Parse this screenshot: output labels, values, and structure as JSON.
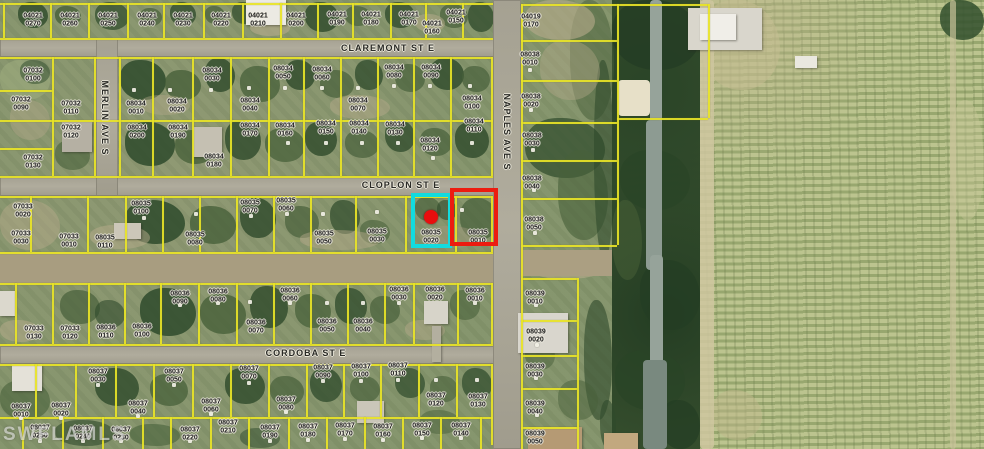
{
  "watermark": "SWFLAMLS",
  "colors": {
    "parcel_line": "#e9e427",
    "subject_highlight": "#12dbde",
    "adjacent_highlight": "#ec1c10",
    "marker": "#e80e0e"
  },
  "street_labels": [
    {
      "name": "CLAREMONT ST E",
      "x": 388,
      "y": 48,
      "vertical": false
    },
    {
      "name": "CLOPLON ST E",
      "x": 401,
      "y": 185,
      "vertical": false
    },
    {
      "name": "CORDOBA ST E",
      "x": 306,
      "y": 353,
      "vertical": false
    },
    {
      "name": "MERLIN AVE S",
      "x": 105,
      "y": 118,
      "vertical": true
    },
    {
      "name": "NAPLES AVE S",
      "x": 507,
      "y": 132,
      "vertical": true
    }
  ],
  "highlights": {
    "subject_parcel": "08035 0020",
    "adjacent_parcel": "08035 0010",
    "marker": {
      "x": 431,
      "y": 217
    }
  },
  "parcel_labels": [
    {
      "block": "04021",
      "lot": "0270",
      "x": 33,
      "y": 20
    },
    {
      "block": "04021",
      "lot": "0260",
      "x": 70,
      "y": 20
    },
    {
      "block": "04021",
      "lot": "0250",
      "x": 108,
      "y": 20
    },
    {
      "block": "04021",
      "lot": "0240",
      "x": 147,
      "y": 20
    },
    {
      "block": "04021",
      "lot": "0230",
      "x": 183,
      "y": 20
    },
    {
      "block": "04021",
      "lot": "0220",
      "x": 221,
      "y": 20
    },
    {
      "block": "04021",
      "lot": "0210",
      "x": 258,
      "y": 20
    },
    {
      "block": "04021",
      "lot": "0200",
      "x": 296,
      "y": 20
    },
    {
      "block": "04021",
      "lot": "0190",
      "x": 337,
      "y": 19
    },
    {
      "block": "04021",
      "lot": "0180",
      "x": 371,
      "y": 19
    },
    {
      "block": "04021",
      "lot": "0170",
      "x": 409,
      "y": 19
    },
    {
      "block": "04021",
      "lot": "0160",
      "x": 432,
      "y": 28
    },
    {
      "block": "04021",
      "lot": "0150",
      "x": 456,
      "y": 17
    },
    {
      "block": "04019",
      "lot": "0170",
      "x": 531,
      "y": 21
    },
    {
      "block": "07032",
      "lot": "0100",
      "x": 33,
      "y": 75
    },
    {
      "block": "07032",
      "lot": "0090",
      "x": 21,
      "y": 104
    },
    {
      "block": "07032",
      "lot": "0110",
      "x": 71,
      "y": 108
    },
    {
      "block": "07032",
      "lot": "0120",
      "x": 71,
      "y": 132
    },
    {
      "block": "07032",
      "lot": "0130",
      "x": 33,
      "y": 162
    },
    {
      "block": "08034",
      "lot": "0010",
      "x": 136,
      "y": 108
    },
    {
      "block": "08034",
      "lot": "0020",
      "x": 177,
      "y": 106
    },
    {
      "block": "08034",
      "lot": "0030",
      "x": 212,
      "y": 75
    },
    {
      "block": "08034",
      "lot": "0040",
      "x": 250,
      "y": 105
    },
    {
      "block": "08034",
      "lot": "0050",
      "x": 283,
      "y": 73
    },
    {
      "block": "08034",
      "lot": "0060",
      "x": 322,
      "y": 74
    },
    {
      "block": "08034",
      "lot": "0070",
      "x": 358,
      "y": 105
    },
    {
      "block": "08034",
      "lot": "0080",
      "x": 394,
      "y": 72
    },
    {
      "block": "08034",
      "lot": "0090",
      "x": 431,
      "y": 72
    },
    {
      "block": "08034",
      "lot": "0100",
      "x": 472,
      "y": 103
    },
    {
      "block": "08034",
      "lot": "0200",
      "x": 137,
      "y": 132
    },
    {
      "block": "08034",
      "lot": "0190",
      "x": 178,
      "y": 132
    },
    {
      "block": "08034",
      "lot": "0180",
      "x": 214,
      "y": 161
    },
    {
      "block": "08034",
      "lot": "0170",
      "x": 250,
      "y": 130
    },
    {
      "block": "08034",
      "lot": "0160",
      "x": 285,
      "y": 130
    },
    {
      "block": "08034",
      "lot": "0150",
      "x": 326,
      "y": 128
    },
    {
      "block": "08034",
      "lot": "0140",
      "x": 359,
      "y": 128
    },
    {
      "block": "08034",
      "lot": "0130",
      "x": 395,
      "y": 129
    },
    {
      "block": "08034",
      "lot": "0120",
      "x": 430,
      "y": 145
    },
    {
      "block": "08034",
      "lot": "0110",
      "x": 474,
      "y": 126
    },
    {
      "block": "07033",
      "lot": "0020",
      "x": 23,
      "y": 211
    },
    {
      "block": "07033",
      "lot": "0030",
      "x": 21,
      "y": 238
    },
    {
      "block": "07033",
      "lot": "0010",
      "x": 69,
      "y": 241
    },
    {
      "block": "08035",
      "lot": "0110",
      "x": 105,
      "y": 242
    },
    {
      "block": "08035",
      "lot": "0100",
      "x": 141,
      "y": 208
    },
    {
      "block": "08035",
      "lot": "0080",
      "x": 195,
      "y": 239
    },
    {
      "block": "08035",
      "lot": "0070",
      "x": 250,
      "y": 207
    },
    {
      "block": "08035",
      "lot": "0060",
      "x": 286,
      "y": 205
    },
    {
      "block": "08035",
      "lot": "0050",
      "x": 324,
      "y": 238
    },
    {
      "block": "08035",
      "lot": "0030",
      "x": 377,
      "y": 236
    },
    {
      "block": "08035",
      "lot": "0020",
      "x": 431,
      "y": 237
    },
    {
      "block": "08035",
      "lot": "0010",
      "x": 478,
      "y": 237
    },
    {
      "block": "08038",
      "lot": "0010",
      "x": 530,
      "y": 59
    },
    {
      "block": "08038",
      "lot": "0020",
      "x": 531,
      "y": 101
    },
    {
      "block": "08038",
      "lot": "0030",
      "x": 532,
      "y": 140
    },
    {
      "block": "08038",
      "lot": "0040",
      "x": 532,
      "y": 183
    },
    {
      "block": "08038",
      "lot": "0050",
      "x": 534,
      "y": 224
    },
    {
      "block": "08039",
      "lot": "0010",
      "x": 535,
      "y": 298
    },
    {
      "block": "08039",
      "lot": "0020",
      "x": 536,
      "y": 336
    },
    {
      "block": "08039",
      "lot": "0030",
      "x": 535,
      "y": 371
    },
    {
      "block": "08039",
      "lot": "0040",
      "x": 535,
      "y": 408
    },
    {
      "block": "08039",
      "lot": "0050",
      "x": 535,
      "y": 438
    },
    {
      "block": "07033",
      "lot": "0130",
      "x": 34,
      "y": 333
    },
    {
      "block": "07033",
      "lot": "0120",
      "x": 70,
      "y": 333
    },
    {
      "block": "08036",
      "lot": "0110",
      "x": 106,
      "y": 332
    },
    {
      "block": "08036",
      "lot": "0100",
      "x": 142,
      "y": 331
    },
    {
      "block": "08036",
      "lot": "0090",
      "x": 180,
      "y": 298
    },
    {
      "block": "08036",
      "lot": "0080",
      "x": 218,
      "y": 296
    },
    {
      "block": "08036",
      "lot": "0070",
      "x": 256,
      "y": 327
    },
    {
      "block": "08036",
      "lot": "0060",
      "x": 290,
      "y": 295
    },
    {
      "block": "08036",
      "lot": "0050",
      "x": 327,
      "y": 326
    },
    {
      "block": "08036",
      "lot": "0040",
      "x": 363,
      "y": 326
    },
    {
      "block": "08036",
      "lot": "0030",
      "x": 399,
      "y": 294
    },
    {
      "block": "08036",
      "lot": "0020",
      "x": 435,
      "y": 294
    },
    {
      "block": "08036",
      "lot": "0010",
      "x": 475,
      "y": 295
    },
    {
      "block": "08037",
      "lot": "0030",
      "x": 98,
      "y": 376
    },
    {
      "block": "08037",
      "lot": "0050",
      "x": 174,
      "y": 376
    },
    {
      "block": "08037",
      "lot": "0070",
      "x": 249,
      "y": 373
    },
    {
      "block": "08037",
      "lot": "0090",
      "x": 323,
      "y": 372
    },
    {
      "block": "08037",
      "lot": "0100",
      "x": 361,
      "y": 371
    },
    {
      "block": "08037",
      "lot": "0110",
      "x": 398,
      "y": 370
    },
    {
      "block": "08037",
      "lot": "0120",
      "x": 436,
      "y": 400
    },
    {
      "block": "08037",
      "lot": "0130",
      "x": 478,
      "y": 401
    },
    {
      "block": "08037",
      "lot": "0010",
      "x": 21,
      "y": 411
    },
    {
      "block": "08037",
      "lot": "0020",
      "x": 61,
      "y": 410
    },
    {
      "block": "08037",
      "lot": "0040",
      "x": 138,
      "y": 408
    },
    {
      "block": "08037",
      "lot": "0060",
      "x": 211,
      "y": 406
    },
    {
      "block": "08037",
      "lot": "0080",
      "x": 286,
      "y": 404
    },
    {
      "block": "08037",
      "lot": "0250",
      "x": 40,
      "y": 432
    },
    {
      "block": "08037",
      "lot": "0240",
      "x": 83,
      "y": 433
    },
    {
      "block": "08037",
      "lot": "0230",
      "x": 121,
      "y": 434
    },
    {
      "block": "08037",
      "lot": "0220",
      "x": 190,
      "y": 434
    },
    {
      "block": "08037",
      "lot": "0210",
      "x": 228,
      "y": 427
    },
    {
      "block": "08037",
      "lot": "0190",
      "x": 270,
      "y": 432
    },
    {
      "block": "08037",
      "lot": "0180",
      "x": 308,
      "y": 431
    },
    {
      "block": "08037",
      "lot": "0170",
      "x": 345,
      "y": 430
    },
    {
      "block": "08037",
      "lot": "0160",
      "x": 383,
      "y": 431
    },
    {
      "block": "08037",
      "lot": "0150",
      "x": 422,
      "y": 430
    },
    {
      "block": "08037",
      "lot": "0140",
      "x": 461,
      "y": 430
    }
  ]
}
